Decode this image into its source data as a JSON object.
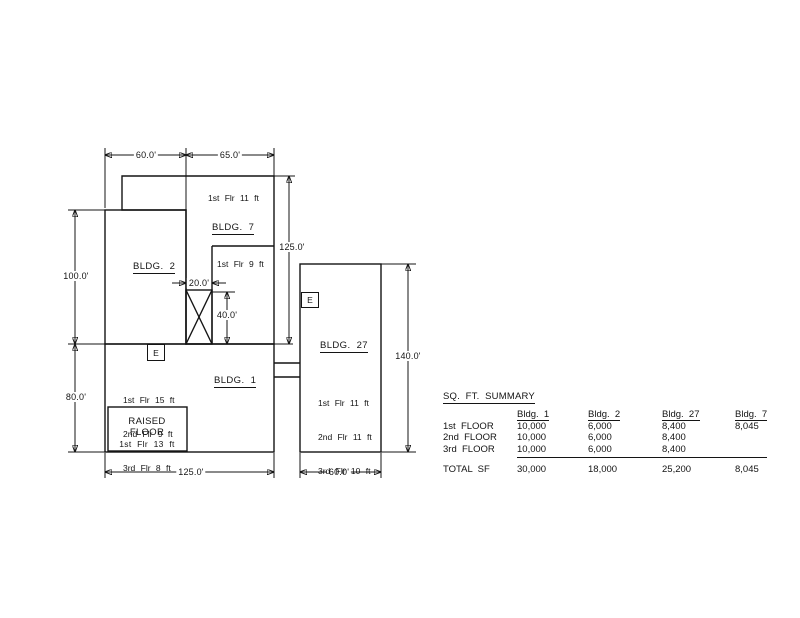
{
  "drawing": {
    "buildings": {
      "bldg2": {
        "label": "BLDG.  2"
      },
      "bldg7": {
        "label": "BLDG.  7",
        "upper_note": "1st Flr 11 ft",
        "lower_note": "1st Flr 9 ft"
      },
      "bldg1": {
        "label": "BLDG.  1",
        "floors": [
          "1st Flr 15 ft",
          "2nd Flr 9 ft",
          "3rd Flr 8 ft"
        ]
      },
      "bldg27": {
        "label": "BLDG.  27",
        "floors": [
          "1st Flr 11 ft",
          "2nd Flr 11 ft",
          "3rd Flr 10 ft"
        ]
      },
      "raised_floor": {
        "line1": "RAISED",
        "line2": "FLOOR",
        "note": "1st Flr 13 ft"
      }
    },
    "elevator_label": "E",
    "dimensions": {
      "top_left": "60.0'",
      "top_right": "65.0'",
      "left_upper": "100.0'",
      "left_lower": "80.0'",
      "bldg7_height": "125.0'",
      "shaft_width": "20.0'",
      "shaft_height": "40.0'",
      "bldg27_height": "140.0'",
      "bottom_left": "125.0'",
      "bottom_right": "60.0'"
    }
  },
  "summary_table": {
    "title": "SQ.  FT.  SUMMARY",
    "columns": [
      "Bldg.  1",
      "Bldg.  2",
      "Bldg.  27",
      "Bldg.  7"
    ],
    "rows": [
      {
        "label": "1st  FLOOR",
        "values": [
          "10,000",
          "6,000",
          "8,400",
          "8,045"
        ]
      },
      {
        "label": "2nd  FLOOR",
        "values": [
          "10,000",
          "6,000",
          "8,400",
          ""
        ]
      },
      {
        "label": "3rd  FLOOR",
        "values": [
          "10,000",
          "6,000",
          "8,400",
          ""
        ]
      }
    ],
    "total": {
      "label": "TOTAL  SF",
      "values": [
        "30,000",
        "18,000",
        "25,200",
        "8,045"
      ]
    }
  },
  "colors": {
    "line": "#141414",
    "background": "#ffffff"
  }
}
